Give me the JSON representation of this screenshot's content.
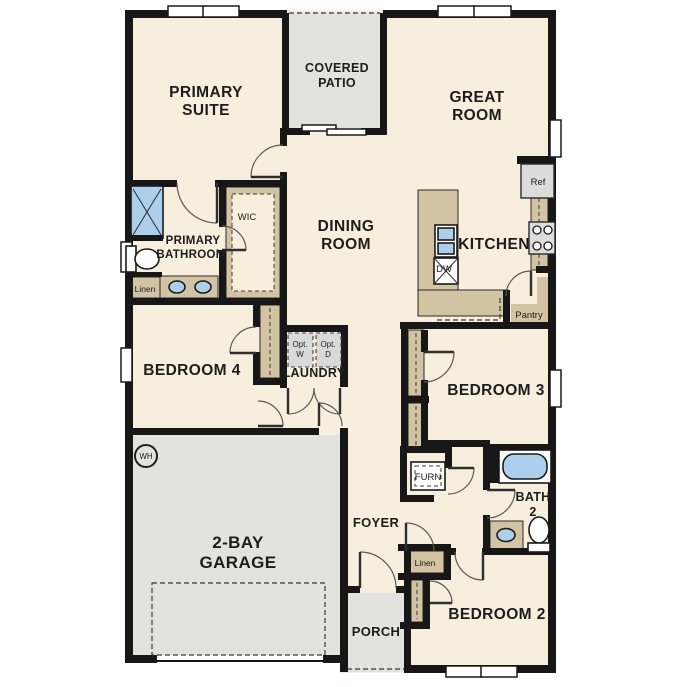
{
  "plan": {
    "type": "single-story residential floor plan",
    "colors": {
      "wall": "#171717",
      "floor": "#f7eedd",
      "outdoor_and_garage": "#e2e2e0",
      "cabinetry": "#d2c3a3",
      "plumbing_fixture": "#aecfec"
    }
  },
  "rooms": {
    "primary_suite": {
      "line1": "PRIMARY",
      "line2": "SUITE"
    },
    "covered_patio": {
      "line1": "COVERED",
      "line2": "PATIO"
    },
    "great_room": {
      "line1": "GREAT",
      "line2": "ROOM"
    },
    "dining_room": {
      "line1": "DINING",
      "line2": "ROOM"
    },
    "kitchen": {
      "label": "KITCHEN"
    },
    "primary_bathroom": {
      "line1": "PRIMARY",
      "line2": "BATHROOM"
    },
    "wic": {
      "label": "WIC"
    },
    "bedroom4": {
      "label": "BEDROOM 4"
    },
    "laundry": {
      "label": "LAUNDRY"
    },
    "bedroom3": {
      "label": "BEDROOM 3"
    },
    "garage": {
      "line1": "2-BAY",
      "line2": "GARAGE"
    },
    "foyer": {
      "label": "FOYER"
    },
    "bath2": {
      "line1": "BATH",
      "line2": "2"
    },
    "bedroom2": {
      "label": "BEDROOM 2"
    },
    "porch": {
      "label": "PORCH"
    }
  },
  "fixtures": {
    "ref": {
      "label": "Ref"
    },
    "dw": {
      "label": "DW"
    },
    "pantry": {
      "label": "Pantry"
    },
    "linen_bath": {
      "label": "Linen"
    },
    "linen_hall": {
      "label": "Linen"
    },
    "furn": {
      "label": "FURN"
    },
    "wh": {
      "label": "WH"
    },
    "opt_w": {
      "line1": "Opt.",
      "line2": "W"
    },
    "opt_d": {
      "line1": "Opt.",
      "line2": "D"
    }
  }
}
